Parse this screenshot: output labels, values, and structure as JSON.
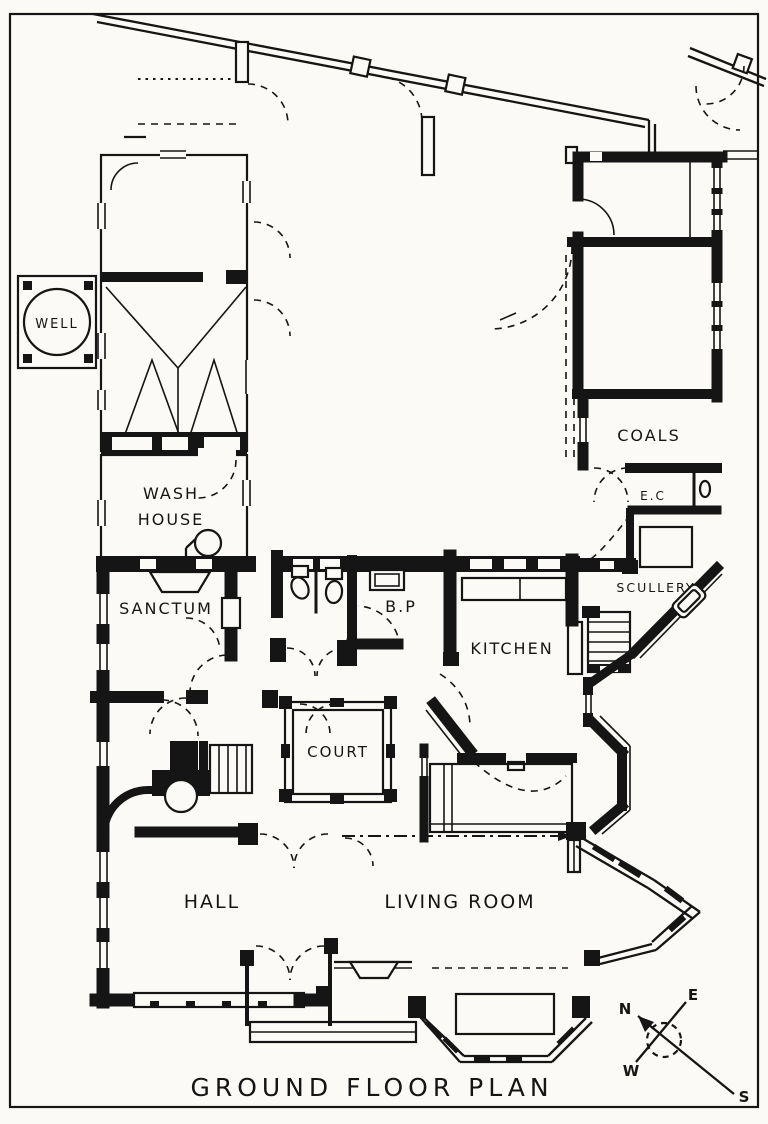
{
  "title": {
    "text": "GROUND FLOOR PLAN"
  },
  "rooms": {
    "well": "WELL",
    "wash_house_line1": "WASH",
    "wash_house_line2": "HOUSE",
    "sanctum": "SANCTUM",
    "bp": "B.P",
    "court": "COURT",
    "kitchen": "KITCHEN",
    "coals": "COALS",
    "ec": "E.C",
    "scullery": "SCULLERY",
    "hall": "HALL",
    "living_room": "LIVING ROOM"
  },
  "compass": {
    "north": "N",
    "east": "E",
    "west": "W",
    "south": "S"
  },
  "colors": {
    "ink": "#151515",
    "paper": "#fbfaf6"
  }
}
